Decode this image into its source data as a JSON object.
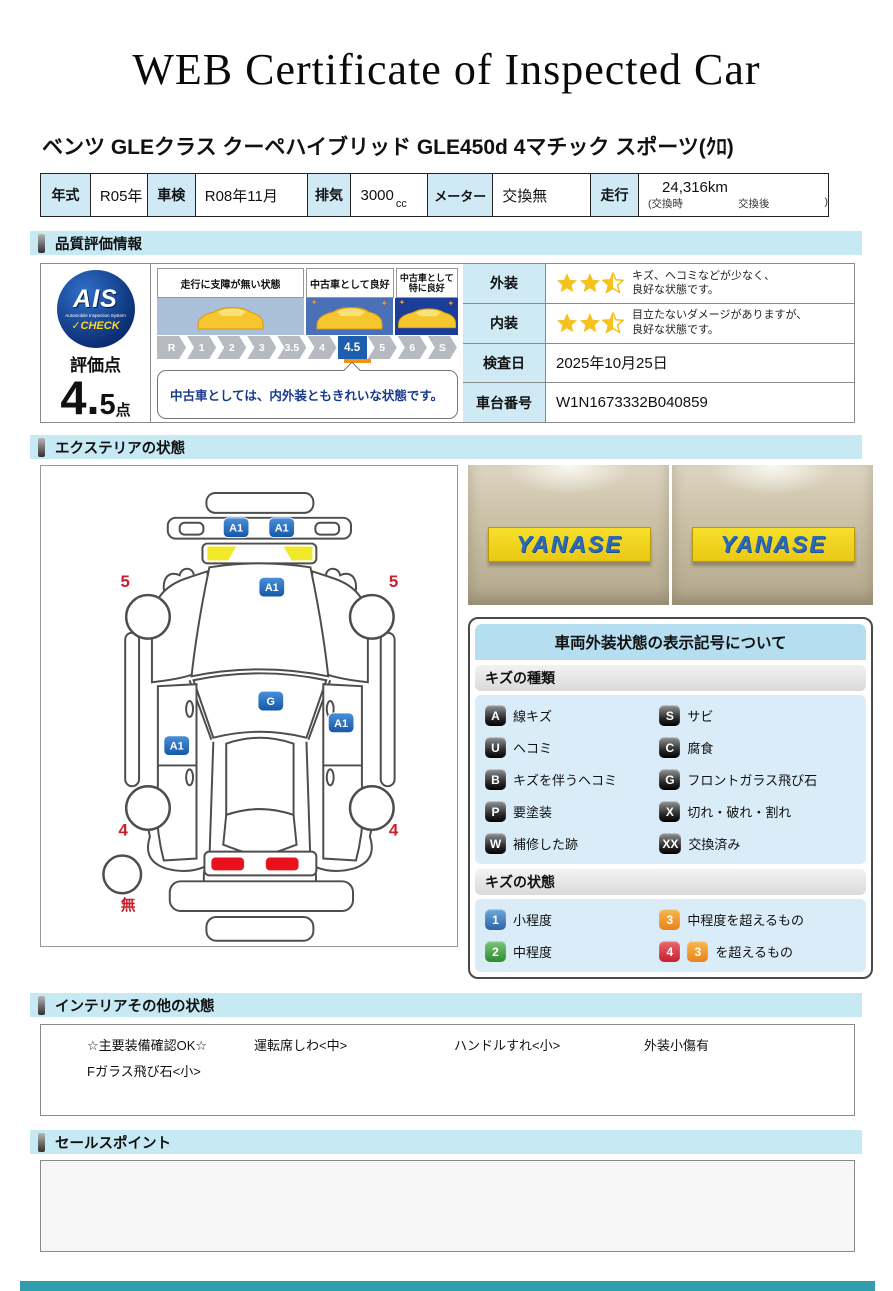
{
  "title": "WEB Certificate of Inspected Car",
  "vehicle": {
    "name": "ベンツ GLEクラス クーペハイブリッド GLE450d 4マチック スポーツ(ｸﾛ)",
    "specs": {
      "year_label": "年式",
      "year": "R05年",
      "shaken_label": "車検",
      "shaken": "R08年11月",
      "displacement_label": "排気",
      "displacement": "3000",
      "displacement_unit": "cc",
      "meter_label": "メーター",
      "meter": "交換無",
      "mileage_label": "走行",
      "mileage": "24,316km",
      "mileage_note_open": "(交換時",
      "mileage_note_mid": "交換後",
      "mileage_note_close": ")"
    }
  },
  "sections": {
    "quality": "品質評価情報",
    "exterior": "エクステリアの状態",
    "interior": "インテリアその他の状態",
    "sales": "セールスポイント"
  },
  "quality": {
    "ais": {
      "main": "AIS",
      "sub": "Automobile Inspection System",
      "check": "✓CHECK"
    },
    "score_label": "評価点",
    "score_main": "4.",
    "score_sub": "5",
    "score_unit": "点",
    "zones": {
      "z1": "走行に支障が無い状態",
      "z2": "中古車として良好",
      "z3a": "中古車として",
      "z3b": "特に良好"
    },
    "scale": [
      "R",
      "1",
      "2",
      "3",
      "3.5",
      "4",
      "4.5",
      "5",
      "6",
      "S"
    ],
    "active_grade": "4.5",
    "comment": "中古車としては、内外装ともきれいな状態です。",
    "rows": [
      {
        "label": "外装",
        "stars": "2.5",
        "text1": "キズ、ヘコミなどが少なく、",
        "text2": "良好な状態です。"
      },
      {
        "label": "内装",
        "stars": "2.5",
        "text1": "目立たないダメージがありますが、",
        "text2": "良好な状態です。"
      },
      {
        "label": "検査日",
        "value": "2025年10月25日"
      },
      {
        "label": "車台番号",
        "value": "W1N1673332B040859"
      }
    ]
  },
  "diagram": {
    "markers": [
      {
        "code": "A1",
        "part": "front-bumper-left"
      },
      {
        "code": "A1",
        "part": "front-bumper-right"
      },
      {
        "code": "A1",
        "part": "hood"
      },
      {
        "code": "G",
        "part": "windshield"
      },
      {
        "code": "A1",
        "part": "right-front-door"
      },
      {
        "code": "A1",
        "part": "left-rear-door"
      }
    ],
    "tire_depths": {
      "front_left": "5",
      "front_right": "5",
      "rear_left": "4",
      "rear_right": "4",
      "spare": "無"
    }
  },
  "photos": {
    "sign_text": "YANASE"
  },
  "legend": {
    "title": "車両外装状態の表示記号について",
    "kind_header": "キズの種類",
    "kinds": [
      {
        "code": "A",
        "label": "線キズ"
      },
      {
        "code": "S",
        "label": "サビ"
      },
      {
        "code": "U",
        "label": "ヘコミ"
      },
      {
        "code": "C",
        "label": "腐食"
      },
      {
        "code": "B",
        "label": "キズを伴うヘコミ"
      },
      {
        "code": "G",
        "label": "フロントガラス飛び石"
      },
      {
        "code": "P",
        "label": "要塗装"
      },
      {
        "code": "X",
        "label": "切れ・破れ・割れ"
      },
      {
        "code": "W",
        "label": "補修した跡"
      },
      {
        "code": "XX",
        "label": "交換済み"
      }
    ],
    "state_header": "キズの状態",
    "states": [
      {
        "code": "1",
        "label": "小程度",
        "color": "#2a64a8"
      },
      {
        "code": "3",
        "label": "中程度を超えるもの",
        "color": "#e8821a"
      },
      {
        "code": "2",
        "label": "中程度",
        "color": "#2e8b2e"
      },
      {
        "code": "4",
        "extra_code": "3",
        "label": "を超えるもの",
        "color": "#c8202e",
        "extra_color": "#e8821a"
      }
    ]
  },
  "interior": {
    "items_row1": [
      "☆主要装備確認OK☆",
      "運転席しわ<中>",
      "ハンドルすれ<小>",
      "外装小傷有"
    ],
    "items_row2": [
      "Fガラス飛び石<小>"
    ]
  },
  "colors": {
    "section_header_bg": "#c6e9f4",
    "table_label_bg": "#cfeaf5",
    "active_grade_bg": "#1d5fae",
    "grade_underline": "#f0930f",
    "star": "#f5c21e",
    "marker_badge": "#1d62b5",
    "headlight_yellow": "#f0e829",
    "taillight_red": "#e8111c",
    "tire_number_red": "#cc1f2e",
    "footer_teal": "#2f9fae"
  }
}
